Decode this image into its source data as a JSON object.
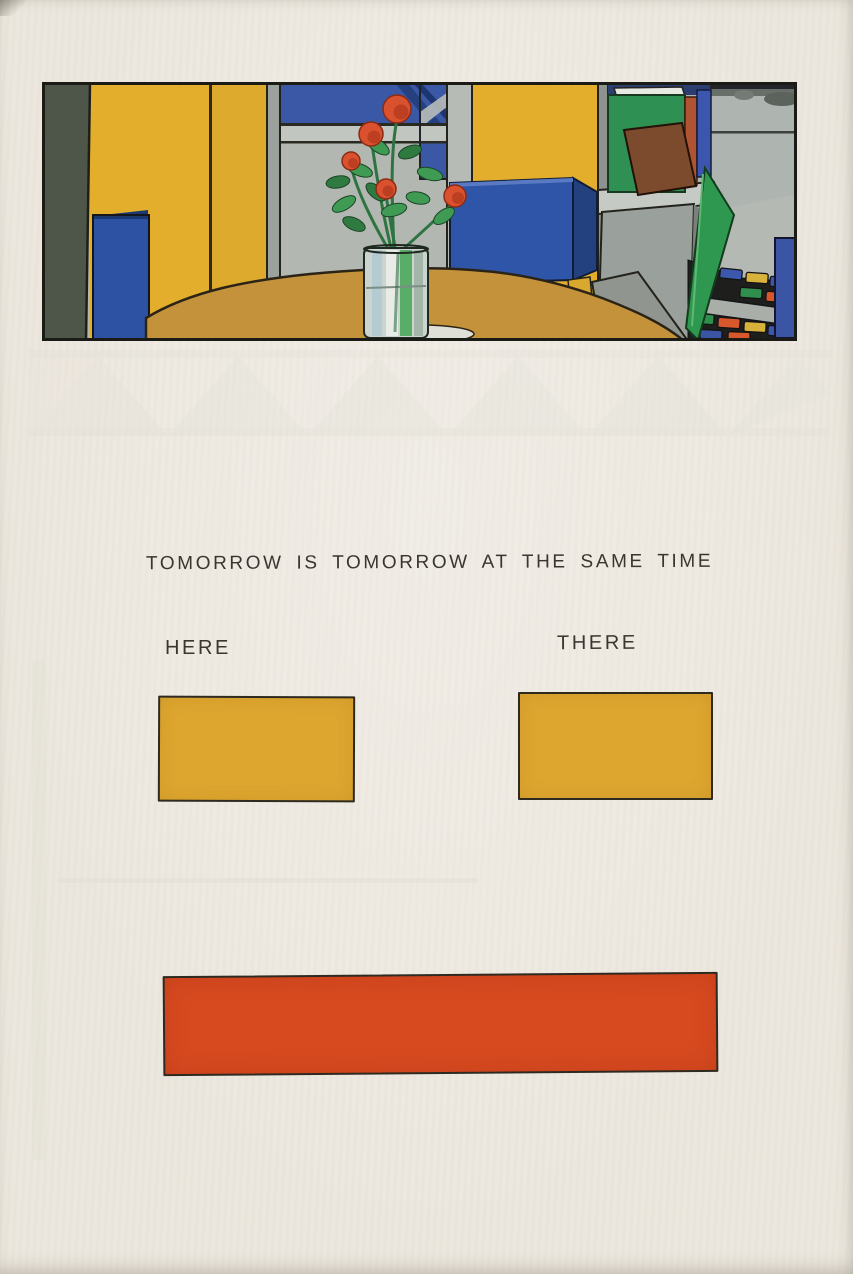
{
  "page": {
    "paper_color": "#ece7de",
    "ink_color": "#3a362f",
    "caption": "TOMORROW IS TOMORROW AT THE SAME TIME",
    "labels": {
      "here": "HERE",
      "there": "THERE"
    }
  },
  "figures": {
    "here_swatch": {
      "fill": "#dda62f",
      "outline": "#2e2a20"
    },
    "there_swatch": {
      "fill": "#dda62f",
      "outline": "#2e2a20"
    },
    "merged_swatch": {
      "fill": "#d74a20",
      "outline": "#2e2a20"
    }
  },
  "artwork": {
    "name": "interior-still-life-with-flowers",
    "description": "Painted interior: vase of red flowers on a round tan table, yellow wall panels, blue boxes, gray window wall, bookshelf with books, green wedge and multicoloured rug",
    "palette": {
      "yellow_wall": "#e2ae2b",
      "wall_gray": "#b2b7b2",
      "window_blue": "#3b58a6",
      "navy": "#24407e",
      "dark_olive": "#4e564a",
      "table_tan": "#c4923a",
      "flower_red": "#d9512e",
      "leaf_green": "#3f9b53",
      "book_green": "#2f9053",
      "book_brown": "#7c4a2d",
      "rug_black": "#1e1e1c",
      "glass_green": "#5aad68"
    }
  }
}
